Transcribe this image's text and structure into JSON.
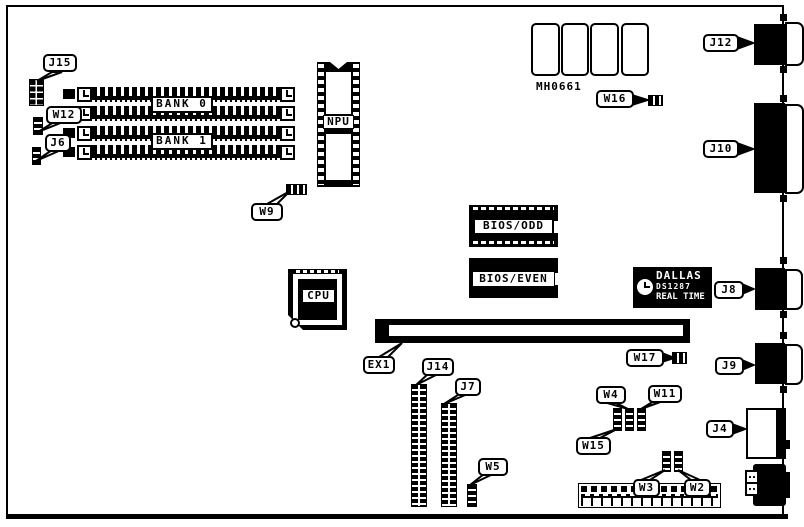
{
  "board": {
    "silkscreen_part_text": "MH0661",
    "labels": {
      "bank0": "BANK 0",
      "bank1": "BANK 1",
      "npu": "NPU",
      "cpu": "CPU",
      "bios_odd": "BIOS/ODD",
      "bios_even": "BIOS/EVEN"
    },
    "rtc": {
      "brand": "DALLAS",
      "model": "DS1287",
      "caption": "REAL TIME"
    },
    "callouts": {
      "j15": "J15",
      "w12": "W12",
      "j6": "J6",
      "w9": "W9",
      "w16": "W16",
      "j12": "J12",
      "j10": "J10",
      "j8": "J8",
      "j9": "J9",
      "j4": "J4",
      "ex1": "EX1",
      "w17": "W17",
      "j14": "J14",
      "j7": "J7",
      "w5": "W5",
      "w4": "W4",
      "w11": "W11",
      "w15": "W15",
      "w3": "W3",
      "w2": "W2"
    },
    "colors": {
      "line": "#000000",
      "background": "#ffffff"
    }
  }
}
